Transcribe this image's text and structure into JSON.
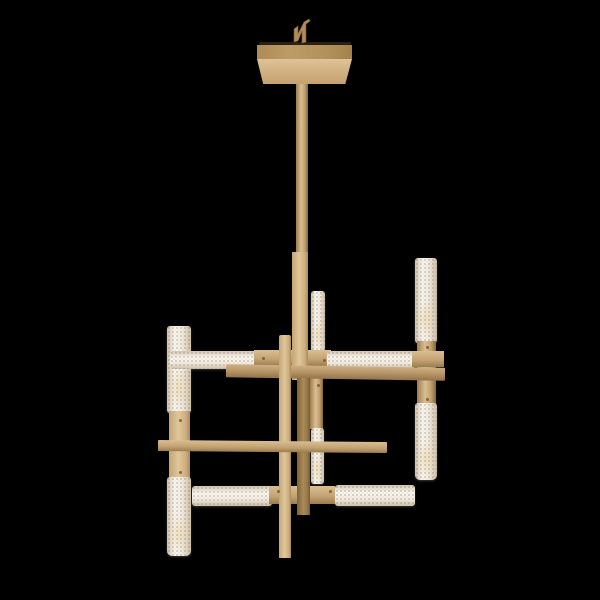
{
  "image": {
    "subject": "Modern geometric chandelier, brass rods with prismatic crystal glass tube lights",
    "view": "front product photo, single fixture, unlit LEDs",
    "background_color": "#000000"
  },
  "colors": {
    "background": "#000000",
    "brass_light": "#d9be92",
    "brass_mid": "#c2a272",
    "brass_dark": "#9c7d4e",
    "brass_deep": "#876838",
    "canopy_shadow_line": "#2a2015",
    "canopy_band": "#b5945e",
    "canopy_face_top": "#ddc397",
    "canopy_face_bottom": "#c6a170",
    "crystal_base": "#f2eee6",
    "crystal_speck_warm": "#decf96",
    "crystal_speck_cool": "#927c5c"
  },
  "parts": {
    "hanger_hook": "small brass hanging loop above canopy",
    "canopy": "square brass ceiling canopy",
    "downrod": "central vertical brass stem",
    "secondary_rod": "offset vertical brass rod",
    "upper_arm": "horizontal brass arm with left and right crystal tube lights",
    "main_arm": "plain horizontal brass arm, upper level",
    "cross_rod": "thin bare brass rod, lower level",
    "lower_arm": "horizontal arm with left and right crystal tube lights",
    "left_light": "vertical crystal tube pair with brass center",
    "center_light": "vertical crystal tube pair with brass center",
    "right_light": "vertical crystal tube pair with brass center"
  }
}
